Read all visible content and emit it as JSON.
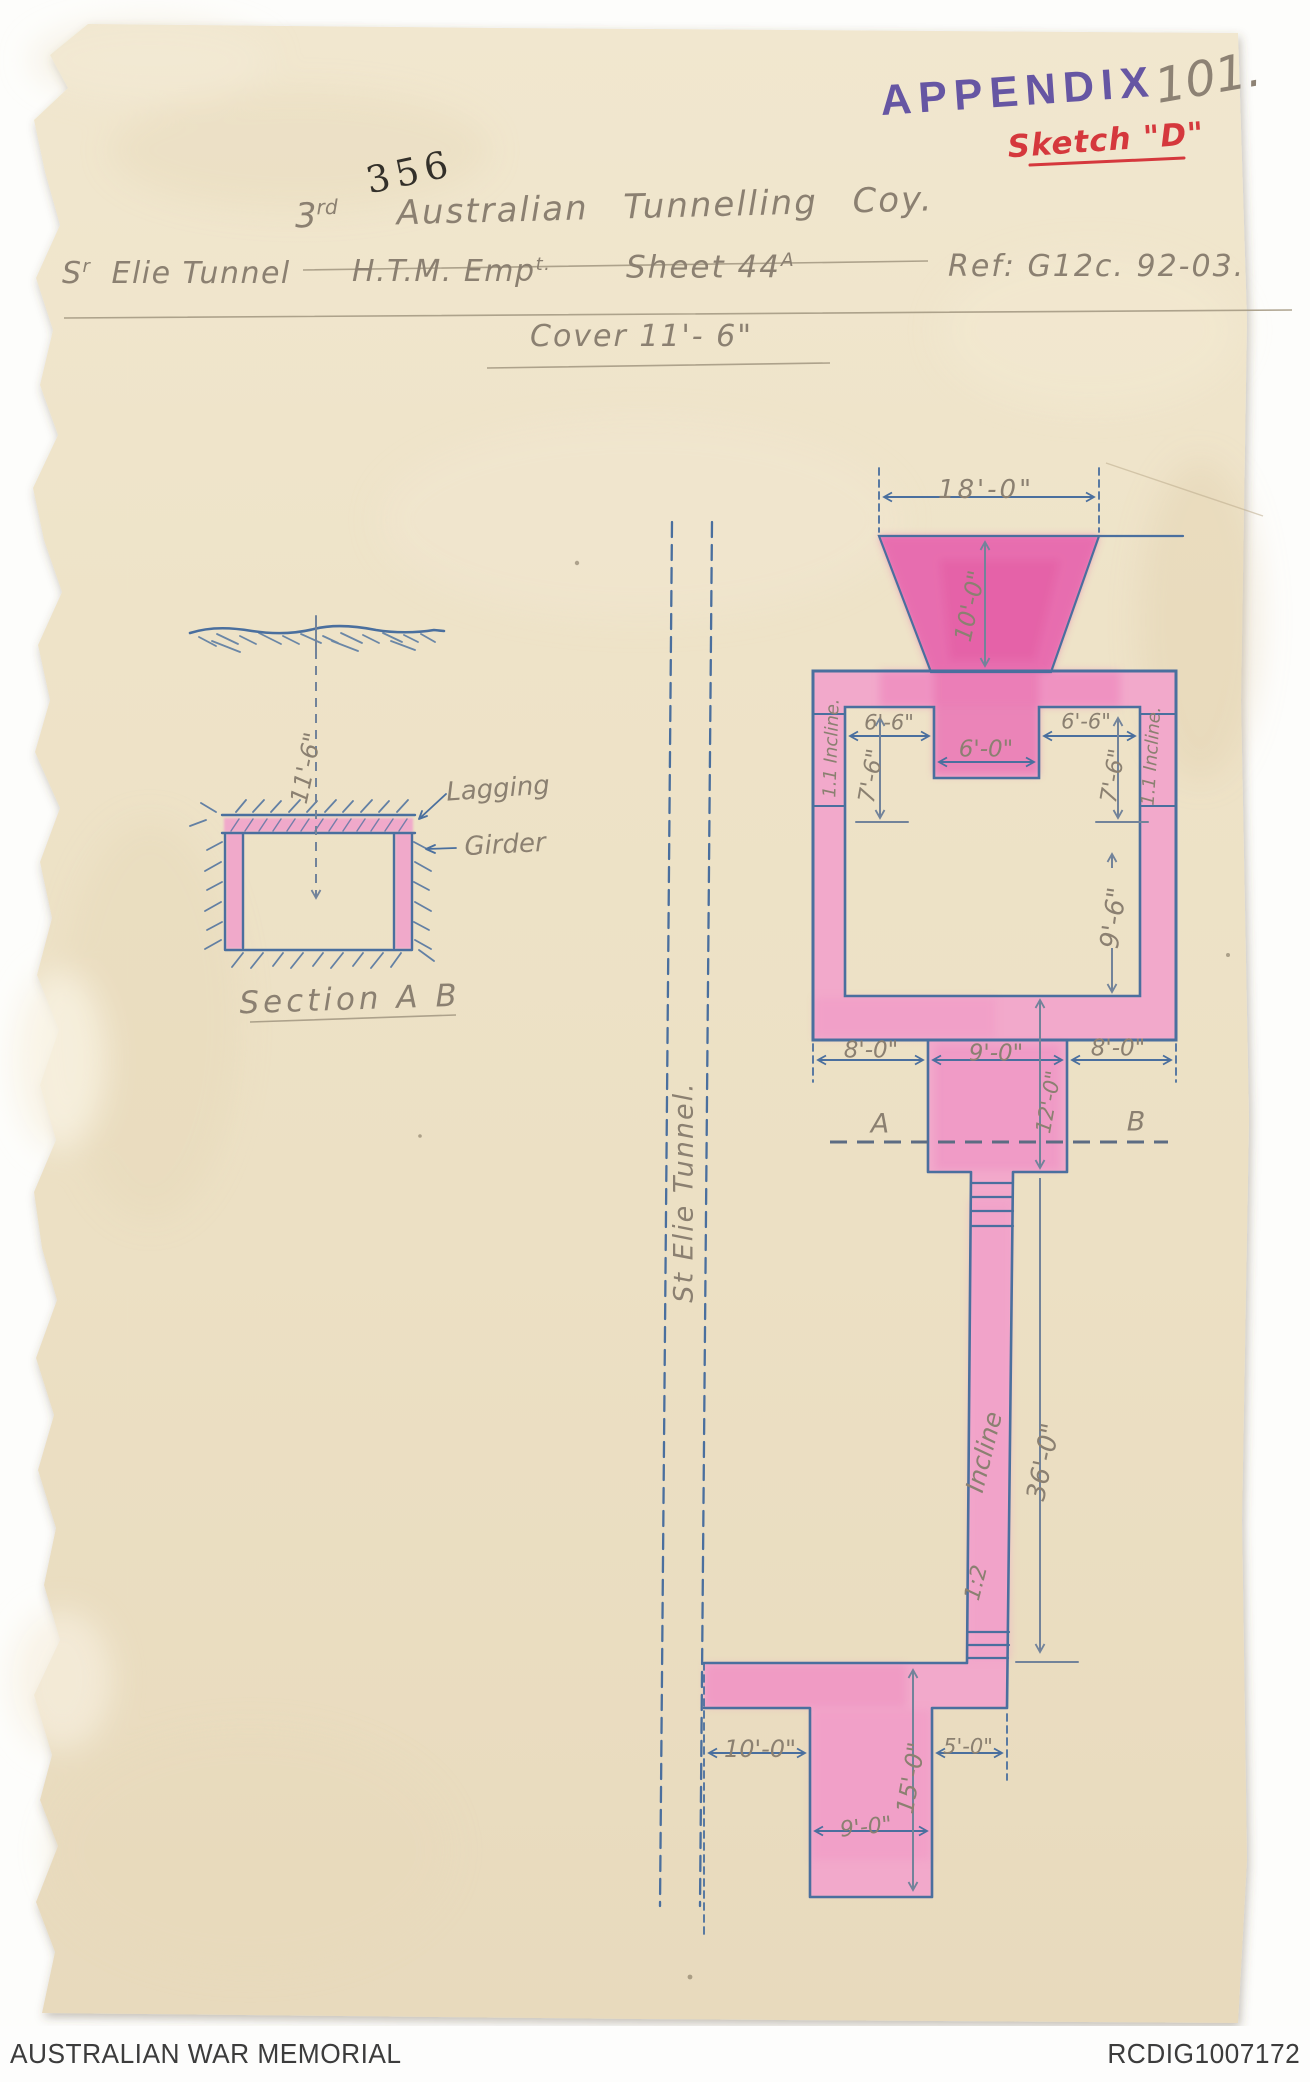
{
  "document": {
    "page_number": "101.",
    "stamp_appendix": "APPENDIX",
    "stamp_serial": "356",
    "sketch_label": "Sketch \"D\""
  },
  "header": {
    "unit_number": "3",
    "unit_ordinal": "rd",
    "unit_name": "Australian Tunnelling Coy.",
    "location_initial": "S",
    "location_initial_sup": "r",
    "location_rest": "Elie Tunnel",
    "system": "H.T.M. Emp",
    "system_sup": "t.",
    "sheet": "Sheet 44",
    "sheet_sup": "A",
    "reference": "Ref: G12c. 92-03.",
    "cover": "Cover 11'- 6\""
  },
  "section_figure": {
    "depth": "11'-6\"",
    "lagging": "Lagging",
    "girder": "Girder",
    "caption": "Section A B"
  },
  "tunnel_label": "St Elie Tunnel.",
  "plan": {
    "crater_width": "18'-0\"",
    "crater_depth": "10'-0\"",
    "ledge_left": "6'-6\"",
    "shaft_top_width": "6'-0\"",
    "ledge_right": "6'-6\"",
    "drop_left": "7'-6\"",
    "drop_right": "7'-6\"",
    "incline_left": "1.1 Incline.",
    "incline_right": "1.1 Incline.",
    "chamber_height": "9'-6\"",
    "base_left": "8'-0\"",
    "base_middle": "9'-0\"",
    "base_right": "8'-0\"",
    "shaft_depth": "12'-0\"",
    "section_point_a": "A",
    "section_point_b": "B",
    "incline_word": "Incline",
    "incline_ratio": "1:2",
    "incline_length": "36'-0\"",
    "gallery_left": "10'-0\"",
    "gallery_right": "5'-0\"",
    "winze_depth": "15'-0\"",
    "winze_width": "9'-0\""
  },
  "footer": {
    "organisation": "AUSTRALIAN WAR MEMORIAL",
    "reference_id": "RCDIG1007172"
  },
  "colors": {
    "paper": "#eee3c8",
    "ink_blue": "#4a6f9e",
    "pencil": "#8b8071",
    "wash_pink": "#f2a9cb",
    "wash_magenta": "#e45fa6",
    "stamp_purple": "#5b4aa0",
    "ink_red": "#d5383d"
  }
}
